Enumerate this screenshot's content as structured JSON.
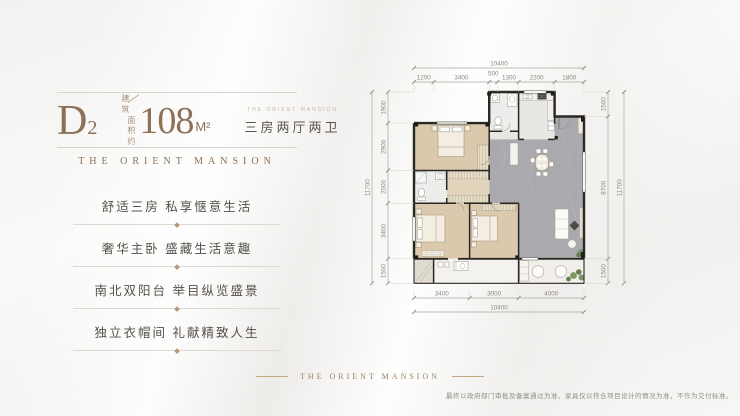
{
  "header": {
    "unit_code": "D",
    "unit_code_sub": "2",
    "area_prefix_top": "建筑",
    "area_prefix_bottom": "面积约",
    "area_value": "108",
    "area_unit": "M²",
    "badge_caption": "THE ORIENT MANSION",
    "badge_text": "三房两厅两卫"
  },
  "brand_title": "THE ORIENT MANSION",
  "selling_points": [
    "舒适三房 私享惬意生活",
    "奢华主卧 盛藏生活意趣",
    "南北双阳台 举目纵览盛景",
    "独立衣帽间 礼献精致人生"
  ],
  "floor_plan": {
    "top_total": "10400",
    "top_segments": [
      "1200",
      "3400",
      "500",
      "1300",
      "2200",
      "1800"
    ],
    "left_total": "11700",
    "left_segments": [
      "1900",
      "2900",
      "2000",
      "3400",
      "1500"
    ],
    "right_total": "11700",
    "right_segments": [
      "1500",
      "8700",
      "1500"
    ],
    "bottom_total": "10400",
    "bottom_segments": [
      "3400",
      "3000",
      "4000"
    ]
  },
  "footer": {
    "brand": "THE ORIENT MANSION",
    "disclaimer": "最终以政府部门审批及备案通过为准，家具仅以符合项目设计的情况为准，不作为交付标准。"
  },
  "colors": {
    "accent_brown": "#8c7157",
    "text_dark": "#56504a",
    "wall": "#2b2823",
    "wood_floor": "#dbc9ad",
    "living_floor": "#a9a9ae",
    "plant_green": "#7a9464"
  }
}
